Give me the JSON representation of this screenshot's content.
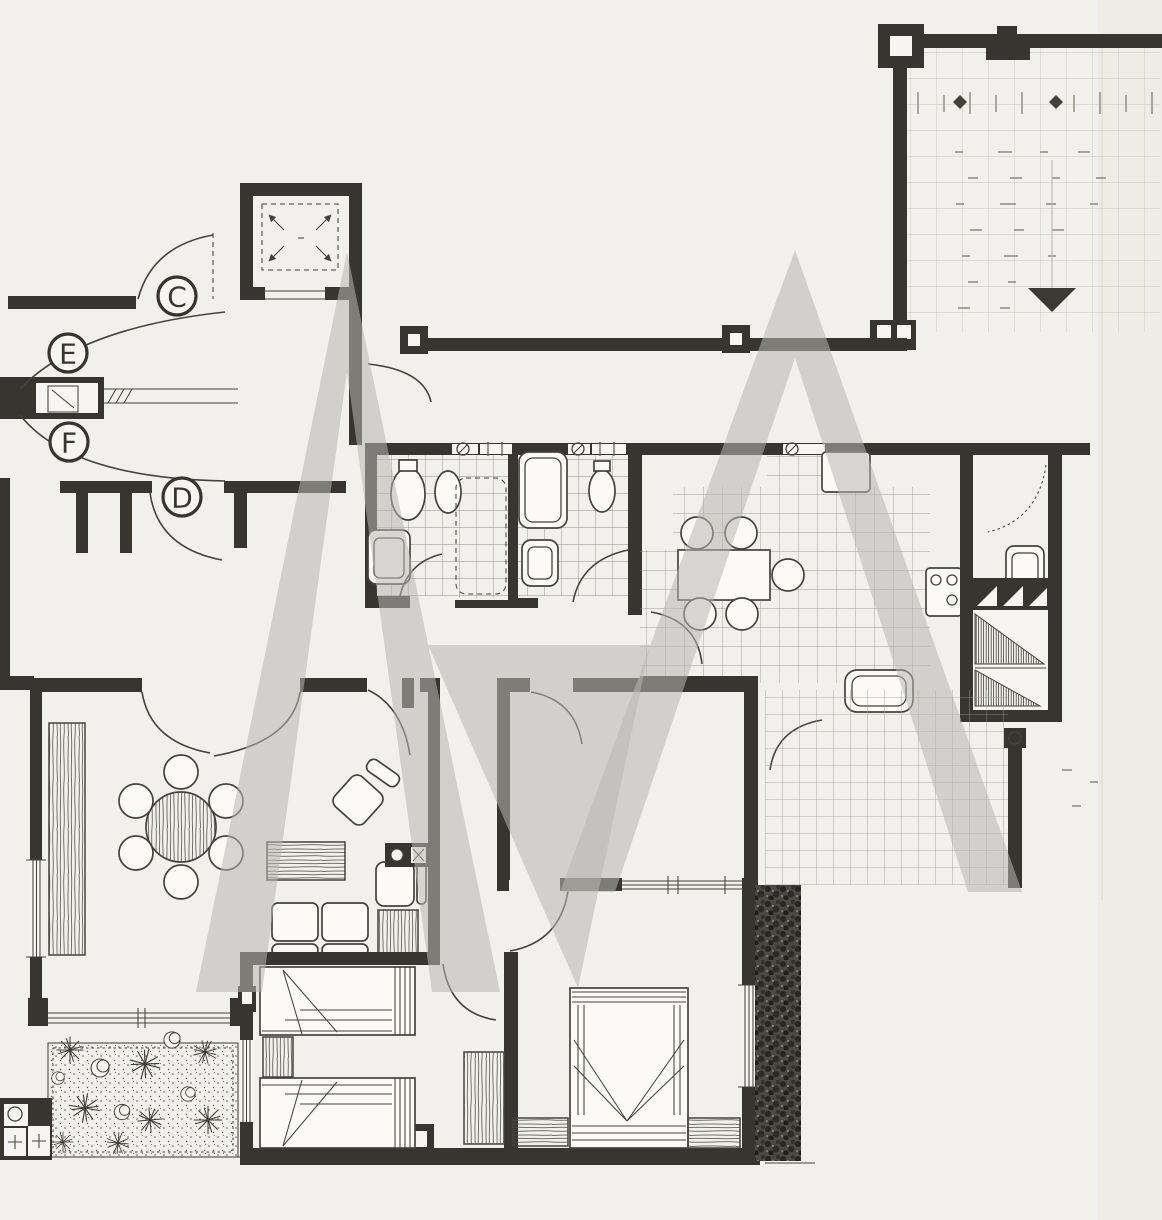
{
  "door_labels": {
    "c": "C",
    "e": "E",
    "f": "F",
    "d": "D"
  },
  "colors": {
    "paper": "#f2f0ec",
    "ink": "#383530",
    "line": "#45423c",
    "tile_line": "#918e88",
    "faint_grid": "#c9c6c0",
    "watermark": "#b8b6b2"
  }
}
